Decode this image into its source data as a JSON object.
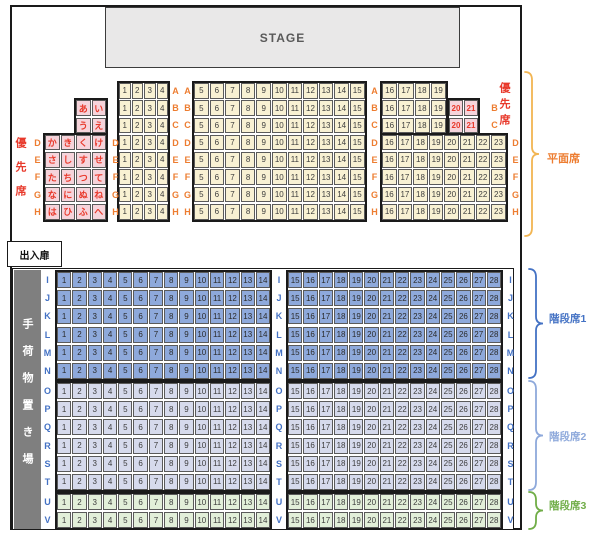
{
  "title_labels": {
    "stage": "STAGE",
    "door": "出入扉",
    "luggage_area": "手荷物置き場",
    "priority_left": "優先席",
    "priority_right": "優先席"
  },
  "legend": {
    "flat": "平面席",
    "stairs1": "階段席1",
    "stairs2": "階段席2",
    "stairs3": "階段席3"
  },
  "colors": {
    "flat_seat": "#F8F1D3",
    "priority_seat": "#F6D4DB",
    "stairs1_seat": "#8EA9DB",
    "stairs2_seat": "#D6DAEC",
    "stairs3_seat": "#E2EFD9",
    "flat_row_label": "#ED7D31",
    "stairs_row_label": "#4472C4",
    "priority_label": "#E8392B",
    "legend_flat": "#ED7D31",
    "legend_stairs1": "#4472C4",
    "legend_stairs2": "#8EA9DB",
    "legend_stairs3": "#70AD47",
    "brace_flat": "#F2B552",
    "luggage_bg": "#7F7F7F"
  },
  "flat_section": {
    "rows": [
      {
        "name": "A",
        "hiragana": [],
        "seats_1_4": [
          1,
          2,
          3,
          4
        ],
        "seats_5_15": [
          5,
          6,
          7,
          8,
          9,
          10,
          11,
          12,
          13,
          14,
          15
        ],
        "seats_right": [
          16,
          17,
          18,
          19
        ],
        "priority_right": []
      },
      {
        "name": "B",
        "hiragana": [
          "あ",
          "い"
        ],
        "seats_1_4": [
          1,
          2,
          3,
          4
        ],
        "seats_5_15": [
          5,
          6,
          7,
          8,
          9,
          10,
          11,
          12,
          13,
          14,
          15
        ],
        "seats_right": [
          16,
          17,
          18,
          19
        ],
        "priority_right": [
          20,
          21
        ]
      },
      {
        "name": "C",
        "hiragana": [
          "う",
          "え"
        ],
        "seats_1_4": [
          1,
          2,
          3,
          4
        ],
        "seats_5_15": [
          5,
          6,
          7,
          8,
          9,
          10,
          11,
          12,
          13,
          14,
          15
        ],
        "seats_right": [
          16,
          17,
          18,
          19
        ],
        "priority_right": [
          20,
          21
        ]
      },
      {
        "name": "D",
        "hiragana": [
          "か",
          "き",
          "く",
          "け"
        ],
        "seats_1_4": [
          1,
          2,
          3,
          4
        ],
        "seats_5_15": [
          5,
          6,
          7,
          8,
          9,
          10,
          11,
          12,
          13,
          14,
          15
        ],
        "seats_right": [
          16,
          17,
          18,
          19,
          20,
          21,
          22,
          23
        ],
        "priority_right": []
      },
      {
        "name": "E",
        "hiragana": [
          "さ",
          "し",
          "す",
          "せ"
        ],
        "seats_1_4": [
          1,
          2,
          3,
          4
        ],
        "seats_5_15": [
          5,
          6,
          7,
          8,
          9,
          10,
          11,
          12,
          13,
          14,
          15
        ],
        "seats_right": [
          16,
          17,
          18,
          19,
          20,
          21,
          22,
          23
        ],
        "priority_right": []
      },
      {
        "name": "F",
        "hiragana": [
          "た",
          "ち",
          "つ",
          "て"
        ],
        "seats_1_4": [
          1,
          2,
          3,
          4
        ],
        "seats_5_15": [
          5,
          6,
          7,
          8,
          9,
          10,
          11,
          12,
          13,
          14,
          15
        ],
        "seats_right": [
          16,
          17,
          18,
          19,
          20,
          21,
          22,
          23
        ],
        "priority_right": []
      },
      {
        "name": "G",
        "hiragana": [
          "な",
          "に",
          "ぬ",
          "ね"
        ],
        "seats_1_4": [
          1,
          2,
          3,
          4
        ],
        "seats_5_15": [
          5,
          6,
          7,
          8,
          9,
          10,
          11,
          12,
          13,
          14,
          15
        ],
        "seats_right": [
          16,
          17,
          18,
          19,
          20,
          21,
          22,
          23
        ],
        "priority_right": []
      },
      {
        "name": "H",
        "hiragana": [
          "は",
          "ひ",
          "ふ",
          "へ"
        ],
        "seats_1_4": [
          1,
          2,
          3,
          4
        ],
        "seats_5_15": [
          5,
          6,
          7,
          8,
          9,
          10,
          11,
          12,
          13,
          14,
          15
        ],
        "seats_right": [
          16,
          17,
          18,
          19,
          20,
          21,
          22,
          23
        ],
        "priority_right": []
      }
    ]
  },
  "stairs_section": {
    "seats_left": [
      1,
      2,
      3,
      4,
      5,
      6,
      7,
      8,
      9,
      10,
      11,
      12,
      13,
      14
    ],
    "seats_right": [
      15,
      16,
      17,
      18,
      19,
      20,
      21,
      22,
      23,
      24,
      25,
      26,
      27,
      28
    ],
    "groups": [
      {
        "legend_key": "stairs1",
        "row_names": [
          "I",
          "J",
          "K",
          "L",
          "M",
          "N"
        ]
      },
      {
        "legend_key": "stairs2",
        "row_names": [
          "O",
          "P",
          "Q",
          "R",
          "S",
          "T"
        ]
      },
      {
        "legend_key": "stairs3",
        "row_names": [
          "U",
          "V"
        ]
      }
    ]
  }
}
